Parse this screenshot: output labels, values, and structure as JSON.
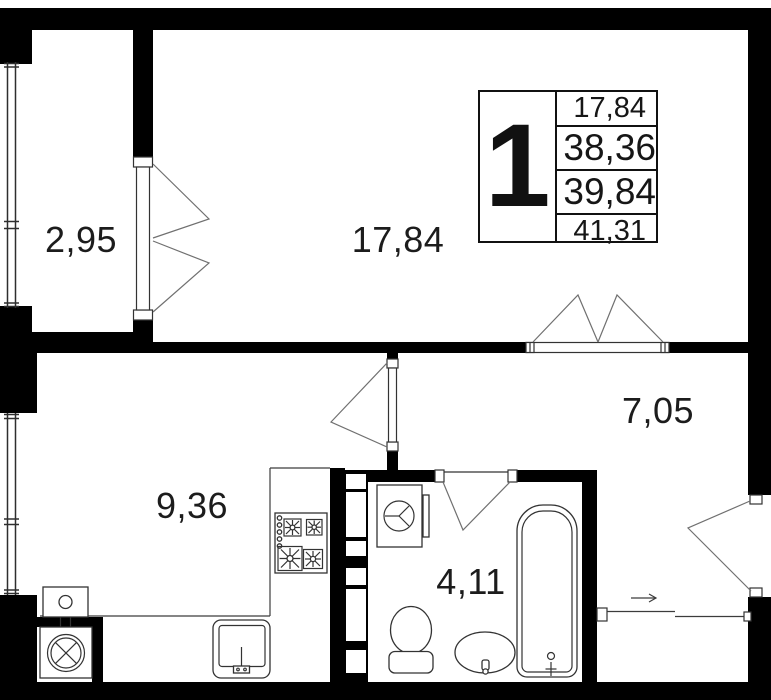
{
  "unit_card": {
    "rooms_count": "1",
    "areas": [
      "17,84",
      "38,36",
      "39,84",
      "41,31"
    ]
  },
  "room_labels": {
    "balcony": "2,95",
    "living_room": "17,84",
    "kitchen": "9,36",
    "hallway": "7,05",
    "bathroom": "4,11"
  },
  "colors": {
    "wall": "#000000",
    "thin_line": "#3c3c3c",
    "swing_line": "#707070",
    "text": "#1c1c1c",
    "background": "#ffffff"
  }
}
